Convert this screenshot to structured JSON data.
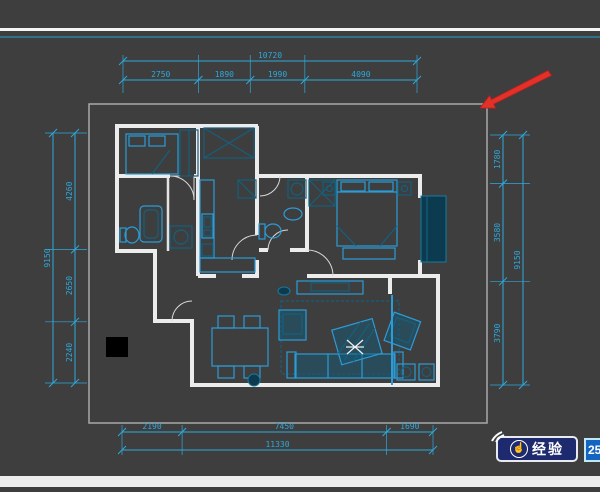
{
  "app": {
    "type": "cad-floorplan-view",
    "background": "#3e3e3e"
  },
  "chrome": {
    "top_white_line_color": "#f4f4f4",
    "top_teal_line_color": "#2f7187",
    "bottom_strip_color": "#ededed"
  },
  "dimensions": {
    "color": "#2da9dd",
    "top": {
      "total": "10720",
      "segments": [
        "2750",
        "1890",
        "1990",
        "4090"
      ]
    },
    "bottom": {
      "total": "11330",
      "segments": [
        "2190",
        "7450",
        "1690"
      ]
    },
    "left": {
      "total": "9150",
      "segments": [
        "4260",
        "2650",
        "2240"
      ]
    },
    "right": {
      "total": "9150",
      "segments": [
        "1780",
        "3580",
        "3790"
      ]
    }
  },
  "floorplan": {
    "wall_color": "#ececec",
    "furniture_color": "#2b9cd8",
    "viewport_border_color": "#a9a9a9"
  },
  "annotations": {
    "red_arrow_color": "#e23128",
    "black_marker_color": "#000000",
    "crosshair_color": "#f0f0f0"
  },
  "watermark": {
    "icon": "☝",
    "badge_label": "经验",
    "score": "250"
  }
}
